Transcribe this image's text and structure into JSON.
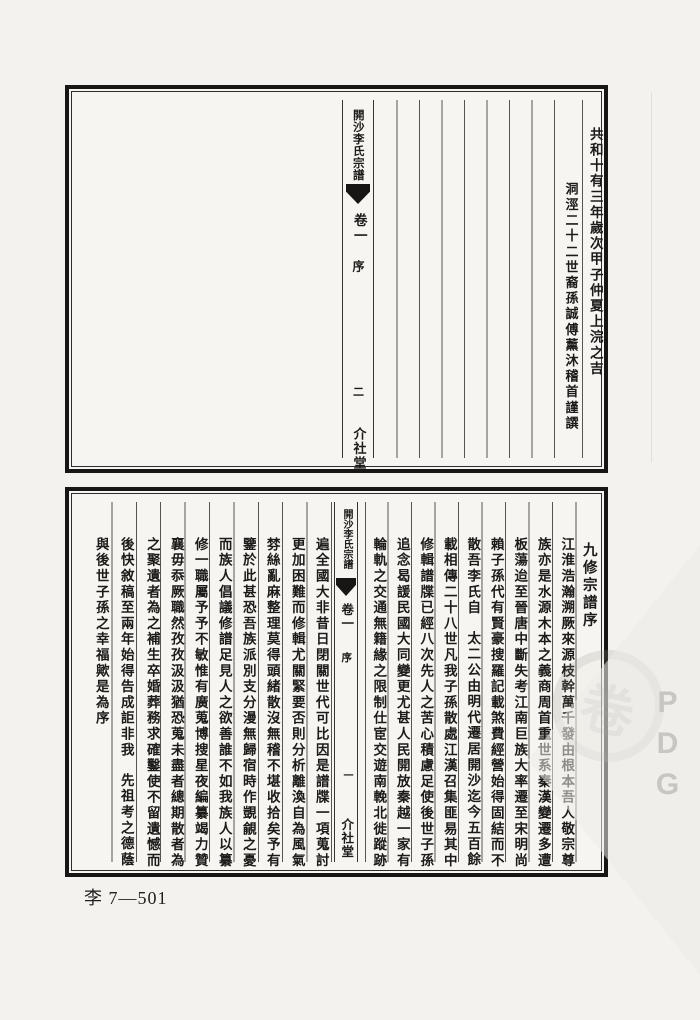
{
  "page": {
    "catalog_label": "李 7—501",
    "watermark_letters": "PDG",
    "seal_char": "卷",
    "ink_color": "#1c1b19",
    "paper_color": "#f6f5f1"
  },
  "top_frame": {
    "spine": {
      "title": "開沙李氏宗譜",
      "volume": "卷一",
      "section": "序",
      "page_number": "二",
      "hall": "介社堂"
    },
    "columns": [
      {
        "segments": [
          "共和十有三年歲次甲子仲夏上浣之吉"
        ]
      },
      {
        "segments": [
          "洞涇二十二世裔孫誠傅薰沐稽首謹譔"
        ]
      }
    ]
  },
  "bottom_frame": {
    "title": "九修宗譜序",
    "spine": {
      "title": "開沙李氏宗譜",
      "volume": "卷一",
      "section": "序",
      "page_number": "一",
      "hall": "介社堂"
    },
    "columns": [
      {
        "segments": [
          "江淮浩瀚溯厥來源枝幹萬千發由根本吾人敬宗尊"
        ]
      },
      {
        "segments": [
          "族亦是水源木本之義商周首重世系秦漢變遷多遭"
        ]
      },
      {
        "segments": [
          "板蕩迨至晉唐中斷失考江南巨族大率遷至宋明尚"
        ]
      },
      {
        "segments": [
          "賴子孫代有賢豪搜羅記載煞費經營始得固結而不"
        ]
      },
      {
        "segments": [
          "散吾李氏自",
          "太二公由明代遷居開沙迄今五百餘"
        ]
      },
      {
        "segments": [
          "載相傳二十八世凡我子孫散處江漢召集匪易其中"
        ]
      },
      {
        "segments": [
          "修輯譜牒已經八次先人之苦心積慮足使後世子孫"
        ]
      },
      {
        "segments": [
          "追念曷諼民國大同變更尤甚人民開放秦越一家有"
        ]
      },
      {
        "segments": [
          "輪軌之交通無籍緣之限制仕宦交遊南輓北徙蹤跡"
        ]
      },
      {
        "segments": [
          "遍全國大非昔日閉關世代可比因是譜牒一項蒐討"
        ]
      },
      {
        "segments": [
          "更加困難而修輯尤關緊要否則分析離渙自為風氣"
        ]
      },
      {
        "segments": [
          "棼絲亂麻整理莫得頭緒散沒無稽不堪收拾矣予有"
        ]
      },
      {
        "segments": [
          "鑒於此甚恐吾族派別支分漫無歸宿時作覬覦之憂"
        ]
      },
      {
        "segments": [
          "而族人倡議修譜足見人之欲善誰不如我族人以纂"
        ]
      },
      {
        "segments": [
          "修一職屬予予不敏惟有廣蒐博搜星夜編纂竭力贊"
        ]
      },
      {
        "segments": [
          "襄毋忝厥職然孜孜汲汲猶恐蒐未盡者總期散者為"
        ]
      },
      {
        "segments": [
          "之聚遺者為之補生卒婚葬務求確鑿使不留遺憾而"
        ]
      },
      {
        "segments": [
          "後快敘稿至兩年始得告成詎非我",
          "先祖考之德蔭"
        ]
      },
      {
        "segments": [
          "與後世子孫之幸福歟是為序"
        ]
      }
    ]
  }
}
